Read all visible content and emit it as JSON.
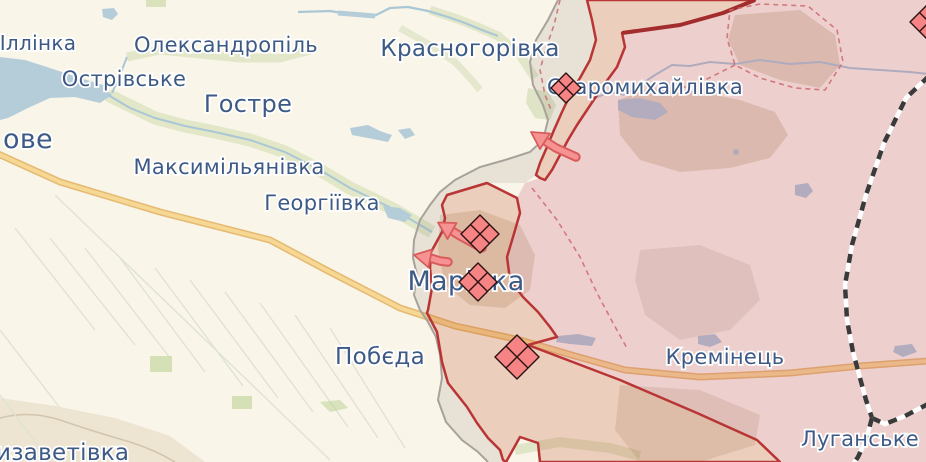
{
  "map": {
    "labels": {
      "illinka": "Іллінка",
      "oleksandropil": "Олександропіль",
      "ostrivske": "Острівське",
      "hostre": "Гостре",
      "ove_partial": "ове",
      "maksymilianivka": "Максимільянівка",
      "heorhiivka": "Георгіївка",
      "krasnohorivka": "Красногорівка",
      "staromykhailivka": "Старомихайлівка",
      "marinka": "Марінка",
      "pobieda": "Побєда",
      "kreminets": "Кремінець",
      "luhanske": "Луганське",
      "yelyzavetivka_partial": "изаветівка"
    },
    "markers": {
      "unit_marker_count": 5,
      "attack_arrow_count": 3
    },
    "colors": {
      "base_map": "#f9f5e9",
      "water": "#b5cdd9",
      "occupied_pink_fill": "rgba(192,72,105,0.21)",
      "active_zone_fill": "rgba(193,84,48,0.24)",
      "grey_zone_fill": "rgba(135,125,118,0.16)",
      "front_line_red": "#b93535",
      "pre2022_line_red": "#a32d2d",
      "grey_zone_line": "#a7a39c",
      "town_label_blue": "#3d5a86",
      "unit_marker_fill": "#f68484",
      "attack_arrow_fill": "#f79292",
      "highway_yellow": "#f6d794",
      "railway_black": "#3a3a3a"
    }
  }
}
